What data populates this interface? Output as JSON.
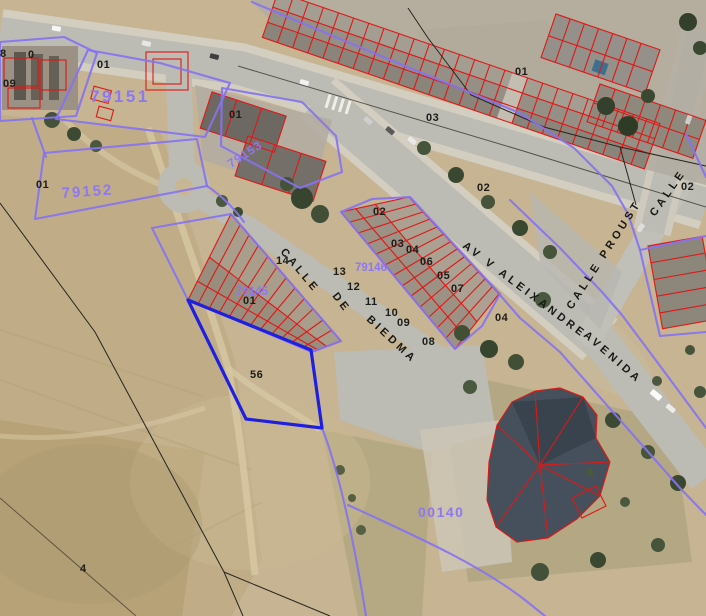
{
  "map": {
    "kind": "cadastral-parcel-overlay-on-aerial-orthophoto",
    "colors": {
      "parcel_boundary": "#8673f0",
      "building_outline": "#df1815",
      "selected_parcel": "#1f1fe0",
      "rural_boundary": "#26251e",
      "block_label": "#8d78f2",
      "number_label": "#1c1c18"
    },
    "labels": {
      "blocks": {
        "b79151": "79151",
        "b79152": "79152",
        "b79153": "79153",
        "b79145": "79145",
        "b79146": "79146",
        "b00140": "00140"
      },
      "streets": {
        "biedma_calle": "CALLE",
        "biedma_de": "DE",
        "biedma_name": "BIEDMA",
        "aleixandre": "AV V ALEIXANDRE",
        "proust": "CALLE PROUST",
        "avenida": "AVENIDA",
        "calle": "CALLE"
      },
      "numbers": [
        {
          "t": "8"
        },
        {
          "t": "0"
        },
        {
          "t": "09"
        },
        {
          "t": "01"
        },
        {
          "t": "01"
        },
        {
          "t": "01"
        },
        {
          "t": "01"
        },
        {
          "t": "03"
        },
        {
          "t": "02"
        },
        {
          "t": "02"
        },
        {
          "t": "02"
        },
        {
          "t": "03"
        },
        {
          "t": "04"
        },
        {
          "t": "06"
        },
        {
          "t": "05"
        },
        {
          "t": "07"
        },
        {
          "t": "14"
        },
        {
          "t": "13"
        },
        {
          "t": "12"
        },
        {
          "t": "11"
        },
        {
          "t": "10"
        },
        {
          "t": "09"
        },
        {
          "t": "08"
        },
        {
          "t": "01"
        },
        {
          "t": "04"
        },
        {
          "t": "56"
        },
        {
          "t": "4"
        }
      ]
    }
  }
}
